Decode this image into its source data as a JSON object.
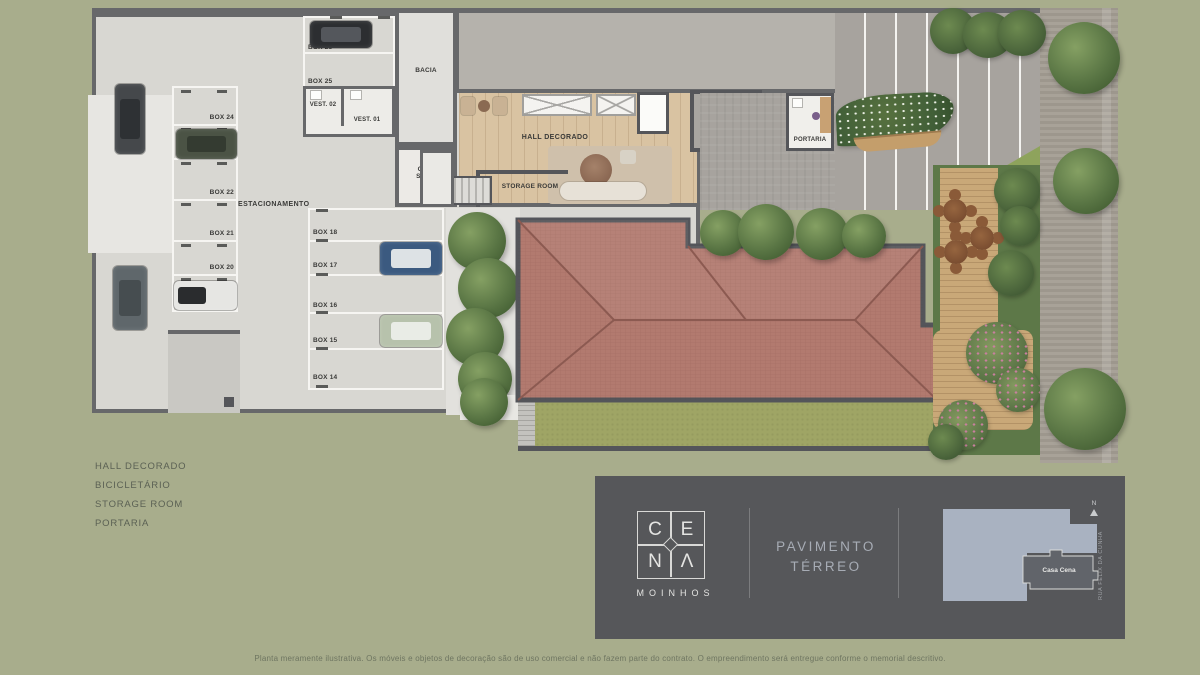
{
  "page": {
    "disclaimer": "Planta meramente ilustrativa. Os móveis e objetos de decoração são de uso comercial e não fazem parte do contrato. O empreendimento será entregue conforme o memorial descritivo."
  },
  "legend": {
    "items": [
      "HALL DECORADO",
      "BICICLETÁRIO",
      "STORAGE ROOM",
      "PORTARIA"
    ]
  },
  "plan": {
    "labels": {
      "estacionamento": "ESTACIONAMENTO",
      "bacia": "BACIA",
      "hall": "HALL DECORADO",
      "storage": "STORAGE ROOM",
      "circ1": "CIRC",
      "circ2": "SERV.",
      "gerador": "GERADOR",
      "portaria": "PORTARIA",
      "vest02": "VEST. 02",
      "vest01": "VEST. 01"
    },
    "stalls_top": [
      "BOX 26",
      "BOX 25"
    ],
    "stalls_left": [
      "BOX 24",
      "BOX 23",
      "BOX 22",
      "BOX 21",
      "BOX 20",
      "BOX 19"
    ],
    "stalls_right": [
      "BOX 18",
      "BOX 17",
      "BOX 16",
      "BOX 15",
      "BOX 14"
    ]
  },
  "brand": {
    "name": "CENA",
    "letters": [
      "C",
      "E",
      "N",
      "Λ"
    ],
    "subtitle": "MOINHOS",
    "floor_line1": "PAVIMENTO",
    "floor_line2": "TÉRREO"
  },
  "minimap": {
    "north": "N",
    "street": "RUA FÉLIX DA CUNHA",
    "unit": "Casa Cena"
  },
  "colors": {
    "background": "#a8ad8c",
    "panel": "#56575a",
    "roof": "#b27a6f",
    "wood": "#d9c3a2",
    "lawn": "#9fa565",
    "accent_text": "#a7acb5"
  }
}
